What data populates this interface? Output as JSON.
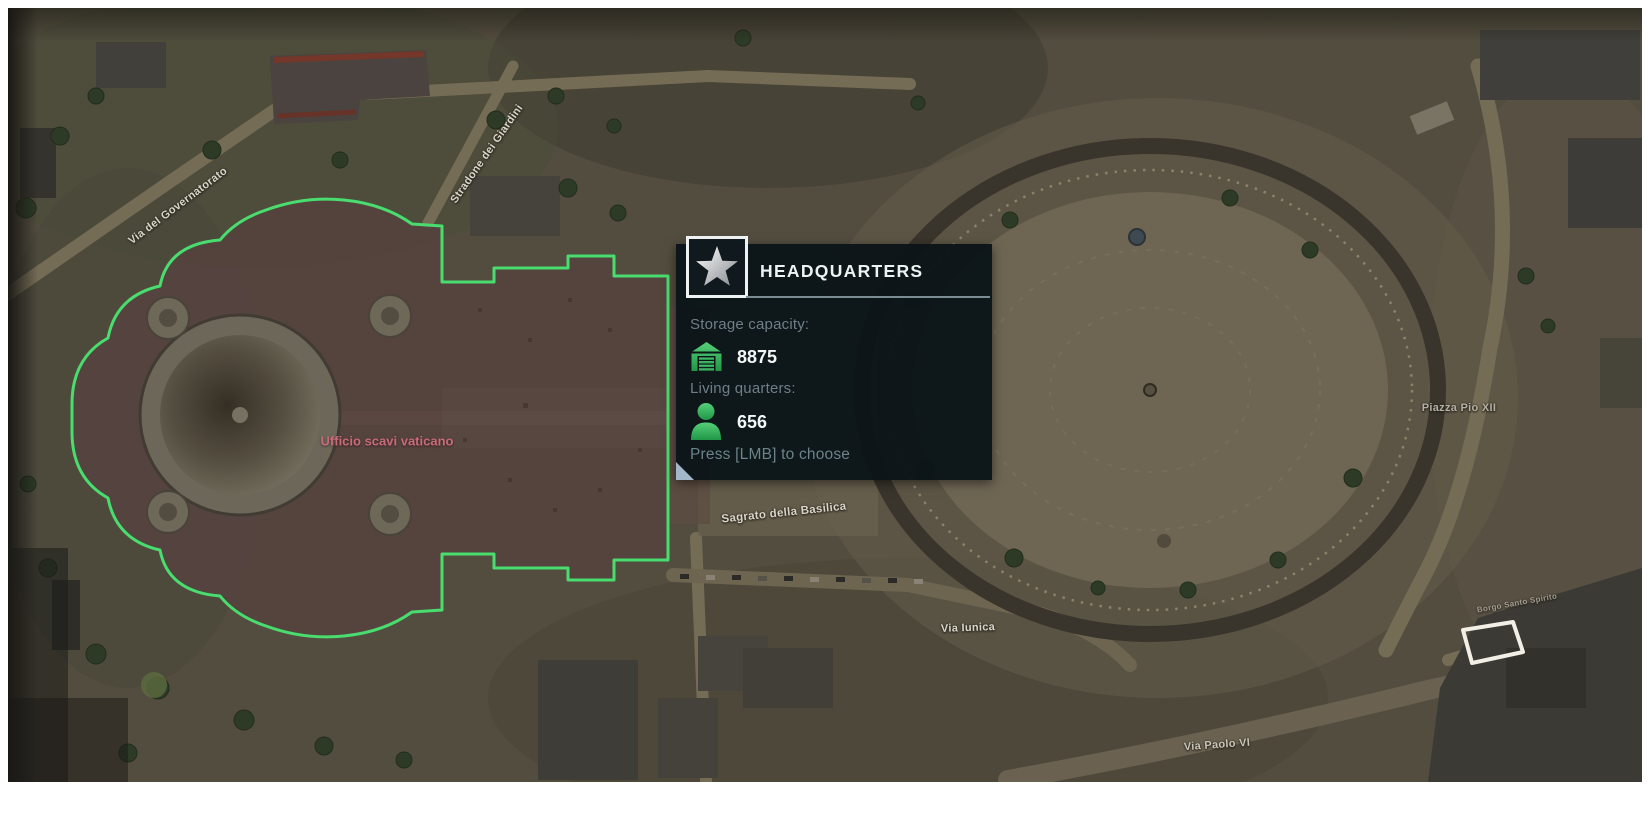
{
  "tooltip": {
    "title": "HEADQUARTERS",
    "icon": "star-icon",
    "stats": [
      {
        "icon": "garage-icon",
        "label": "Storage capacity:",
        "value": "8875"
      },
      {
        "icon": "person-icon",
        "label": "Living quarters:",
        "value": "656"
      }
    ],
    "action_hint": "Press [LMB] to choose",
    "colors": {
      "background": "#0b1518",
      "title": "#edf2f3",
      "label": "#6e7e88",
      "value": "#f3f6f6",
      "hint": "#6a8489",
      "icon_green": "#35b45c",
      "divider": "#7b8c93",
      "fold": "#a2b7c8"
    }
  },
  "map": {
    "poi_label": {
      "text": "Ufficio scavi vaticano",
      "color": "#c96b79"
    },
    "street_labels": [
      {
        "text": "Via del Governatorato"
      },
      {
        "text": "Stradone dei Giardini"
      },
      {
        "text": "Sagrato della Basilica"
      },
      {
        "text": "Via Iunica"
      },
      {
        "text": "Piazza Pio XII"
      },
      {
        "text": "Via Paolo VI"
      },
      {
        "text": "Borgo Santo Spirito"
      }
    ],
    "selected_building_outline_color": "#49dc6e",
    "candidate_building_outline_color": "#f2efe6"
  }
}
